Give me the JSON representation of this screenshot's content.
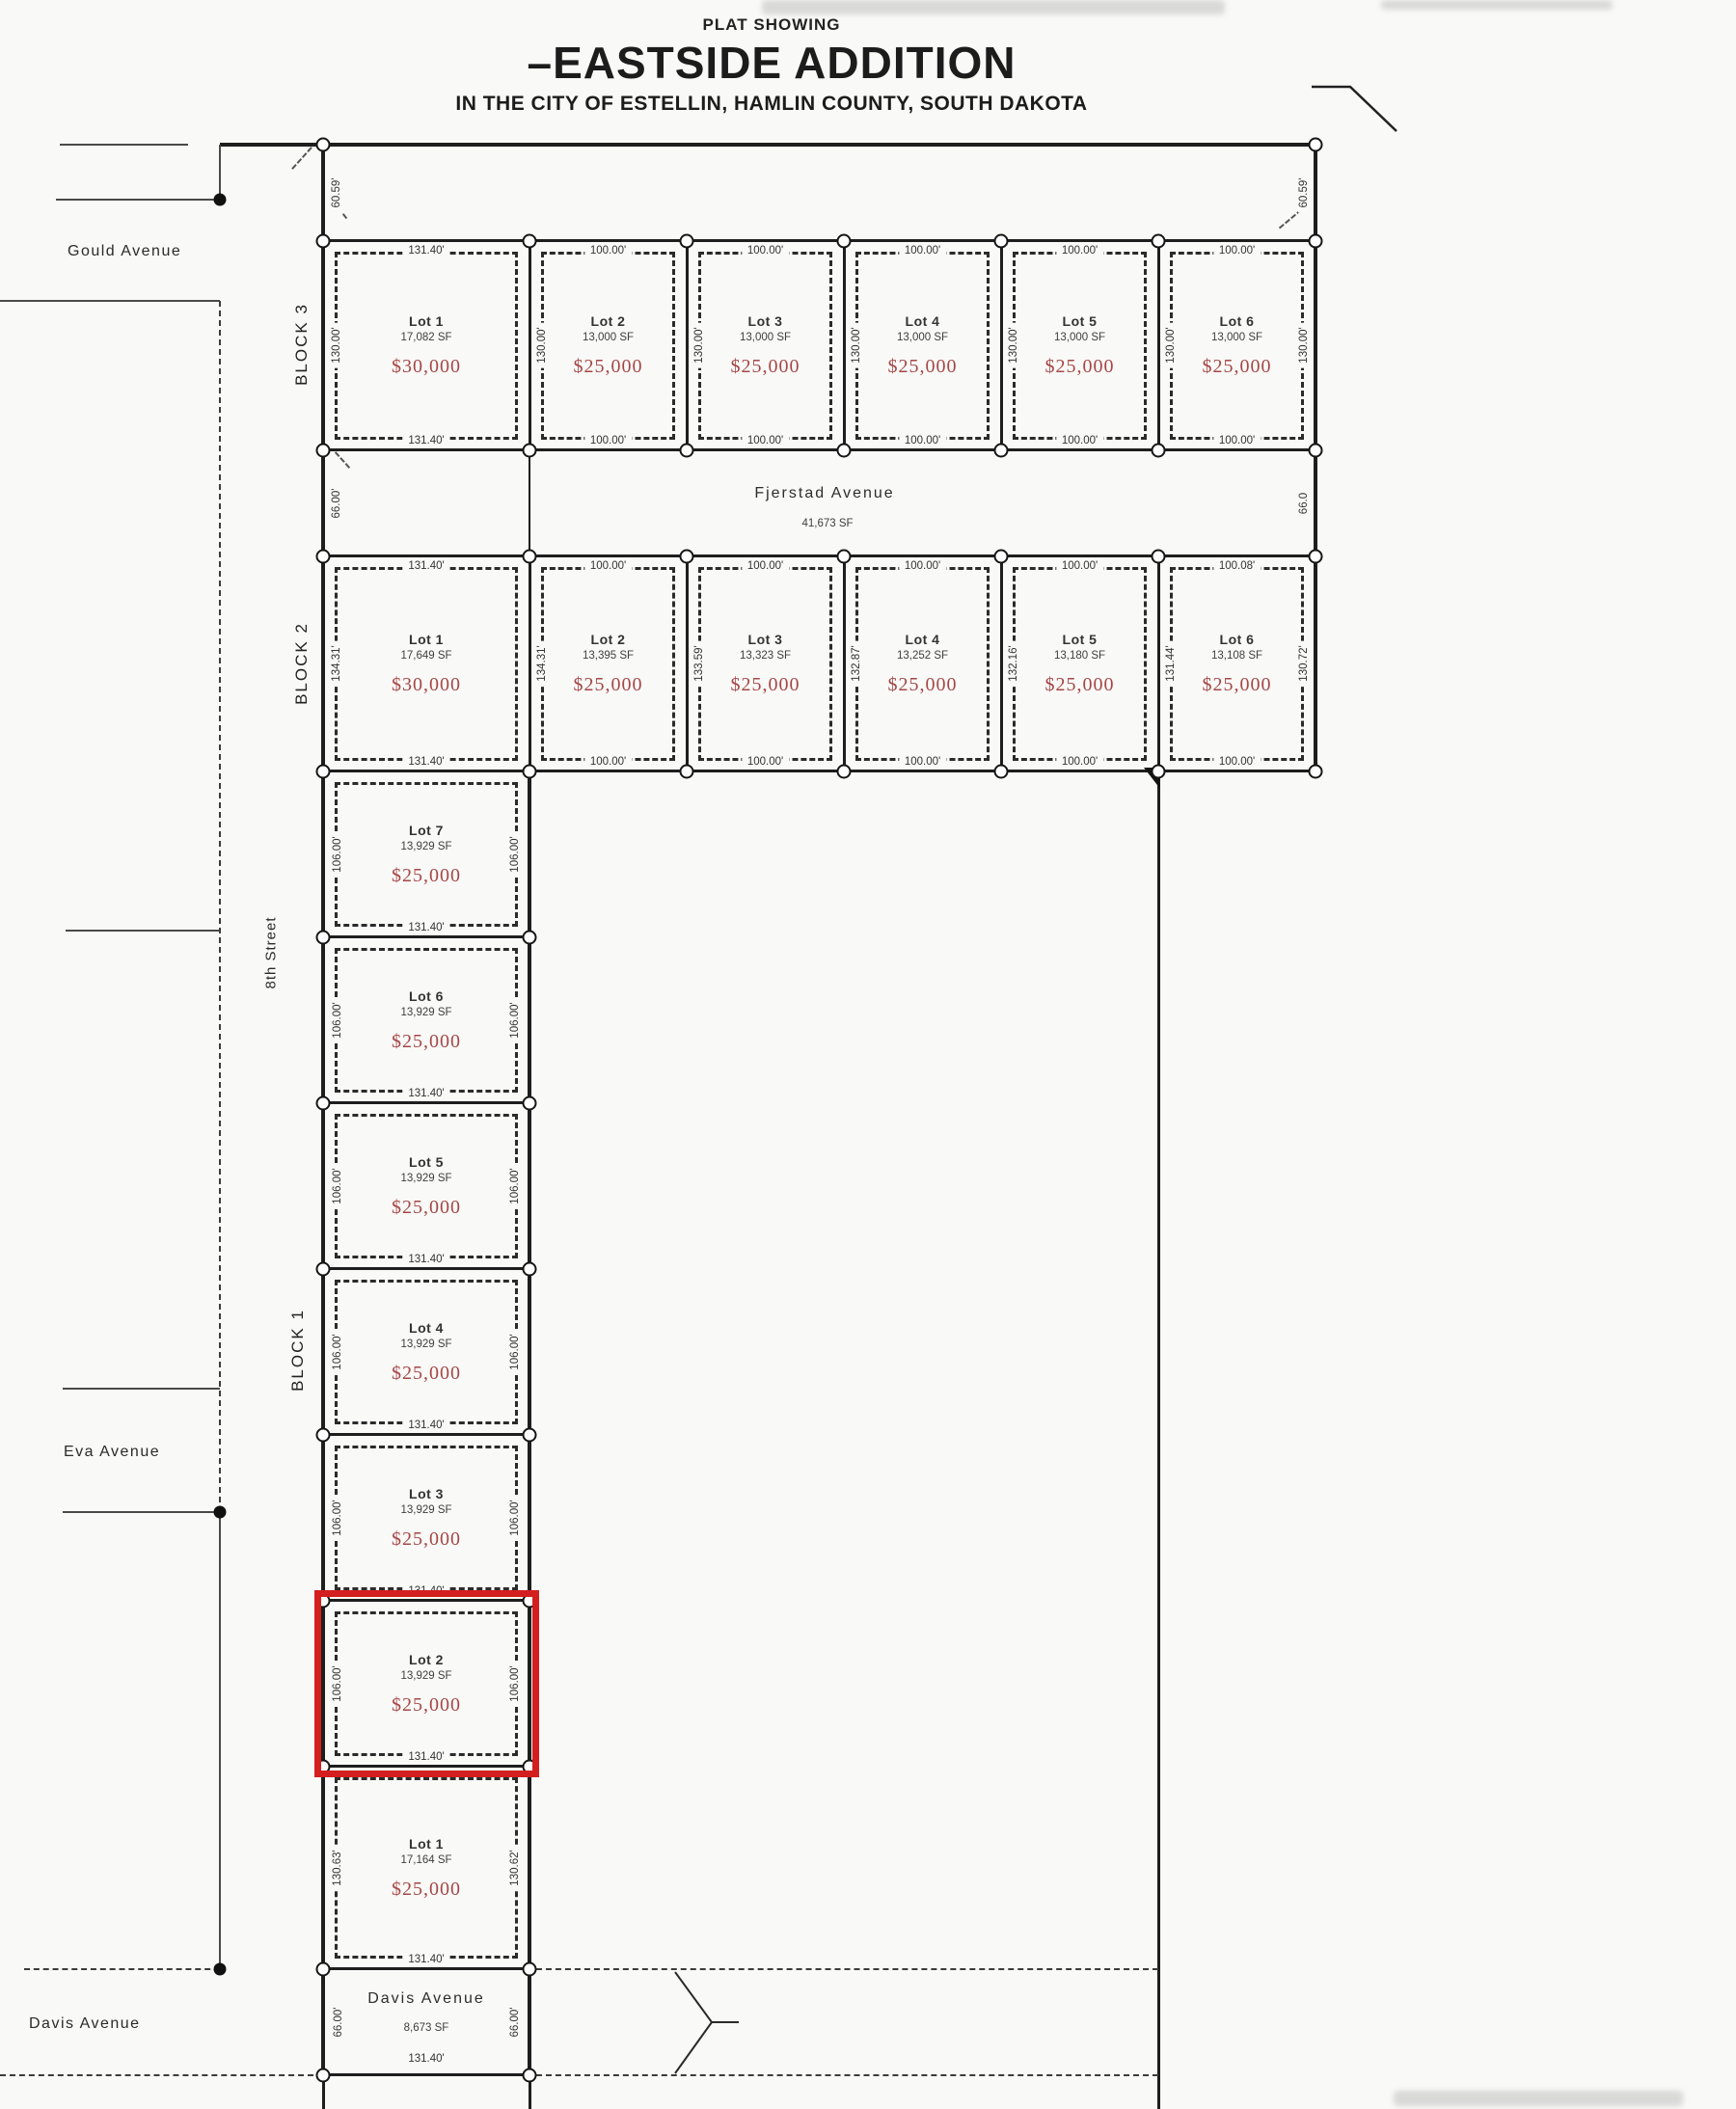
{
  "title": {
    "eyebrow": "PLAT SHOWING",
    "main": "–EASTSIDE ADDITION",
    "subtitle": "IN THE CITY OF ESTELLIN, HAMLIN COUNTY, SOUTH DAKOTA"
  },
  "outer_dims": {
    "nw": "60.59'",
    "ne": "60.59'"
  },
  "streets": {
    "gould": "Gould Avenue",
    "eighth": "8th Street",
    "eva": "Eva Avenue",
    "davis": "Davis Avenue"
  },
  "avenues": {
    "fjerstad": {
      "name": "Fjerstad Avenue",
      "sf": "41,673 SF",
      "left_dim": "66.00'",
      "right_dim": "66.0"
    },
    "davis": {
      "name": "Davis Avenue",
      "sf": "8,673 SF",
      "left_dim": "66.00'",
      "right_dim": "66.00'",
      "bottom_dim": "131.40'"
    }
  },
  "block3": {
    "label": "BLOCK 3",
    "side_dims": [
      "130.00'",
      "130.00'",
      "130.00'",
      "130.00'",
      "130.00'",
      "130.00'",
      "130.00'"
    ],
    "lots": [
      {
        "name": "Lot 1",
        "sf": "17,082 SF",
        "price": "$30,000",
        "top": "131.40'",
        "bottom": "131.40'"
      },
      {
        "name": "Lot 2",
        "sf": "13,000 SF",
        "price": "$25,000",
        "top": "100.00'",
        "bottom": "100.00'"
      },
      {
        "name": "Lot 3",
        "sf": "13,000 SF",
        "price": "$25,000",
        "top": "100.00'",
        "bottom": "100.00'"
      },
      {
        "name": "Lot 4",
        "sf": "13,000 SF",
        "price": "$25,000",
        "top": "100.00'",
        "bottom": "100.00'"
      },
      {
        "name": "Lot 5",
        "sf": "13,000 SF",
        "price": "$25,000",
        "top": "100.00'",
        "bottom": "100.00'"
      },
      {
        "name": "Lot 6",
        "sf": "13,000 SF",
        "price": "$25,000",
        "top": "100.00'",
        "bottom": "100.00'"
      }
    ]
  },
  "block2": {
    "label": "BLOCK 2",
    "side_dims": [
      "134.31'",
      "134.31'",
      "133.59'",
      "132.87'",
      "132.16'",
      "131.44'",
      "130.72'"
    ],
    "lots": [
      {
        "name": "Lot 1",
        "sf": "17,649 SF",
        "price": "$30,000",
        "top": "131.40'",
        "bottom": "131.40'"
      },
      {
        "name": "Lot 2",
        "sf": "13,395 SF",
        "price": "$25,000",
        "top": "100.00'",
        "bottom": "100.00'"
      },
      {
        "name": "Lot 3",
        "sf": "13,323 SF",
        "price": "$25,000",
        "top": "100.00'",
        "bottom": "100.00'"
      },
      {
        "name": "Lot 4",
        "sf": "13,252 SF",
        "price": "$25,000",
        "top": "100.00'",
        "bottom": "100.00'"
      },
      {
        "name": "Lot 5",
        "sf": "13,180 SF",
        "price": "$25,000",
        "top": "100.00'",
        "bottom": "100.00'"
      },
      {
        "name": "Lot 6",
        "sf": "13,108 SF",
        "price": "$25,000",
        "top": "100.08'",
        "bottom": "100.00'"
      }
    ]
  },
  "block1": {
    "label": "BLOCK 1",
    "lots": [
      {
        "name": "Lot 7",
        "sf": "13,929 SF",
        "price": "$25,000",
        "bottom": "131.40'",
        "left": "106.00'",
        "right": "106.00'"
      },
      {
        "name": "Lot 6",
        "sf": "13,929 SF",
        "price": "$25,000",
        "bottom": "131.40'",
        "left": "106.00'",
        "right": "106.00'"
      },
      {
        "name": "Lot 5",
        "sf": "13,929 SF",
        "price": "$25,000",
        "bottom": "131.40'",
        "left": "106.00'",
        "right": "106.00'"
      },
      {
        "name": "Lot 4",
        "sf": "13,929 SF",
        "price": "$25,000",
        "bottom": "131.40'",
        "left": "106.00'",
        "right": "106.00'"
      },
      {
        "name": "Lot 3",
        "sf": "13,929 SF",
        "price": "$25,000",
        "bottom": "131.40'",
        "left": "106.00'",
        "right": "106.00'"
      },
      {
        "name": "Lot 2",
        "sf": "13,929 SF",
        "price": "$25,000",
        "bottom": "131.40'",
        "left": "106.00'",
        "right": "106.00'",
        "highlighted": true
      },
      {
        "name": "Lot 1",
        "sf": "17,164 SF",
        "price": "$25,000",
        "bottom": "131.40'",
        "left": "130.63'",
        "right": "130.62'"
      }
    ]
  },
  "colors": {
    "highlight_red": "#d31f1f",
    "price_red": "#a54747",
    "line_black": "#1e1e1e"
  }
}
